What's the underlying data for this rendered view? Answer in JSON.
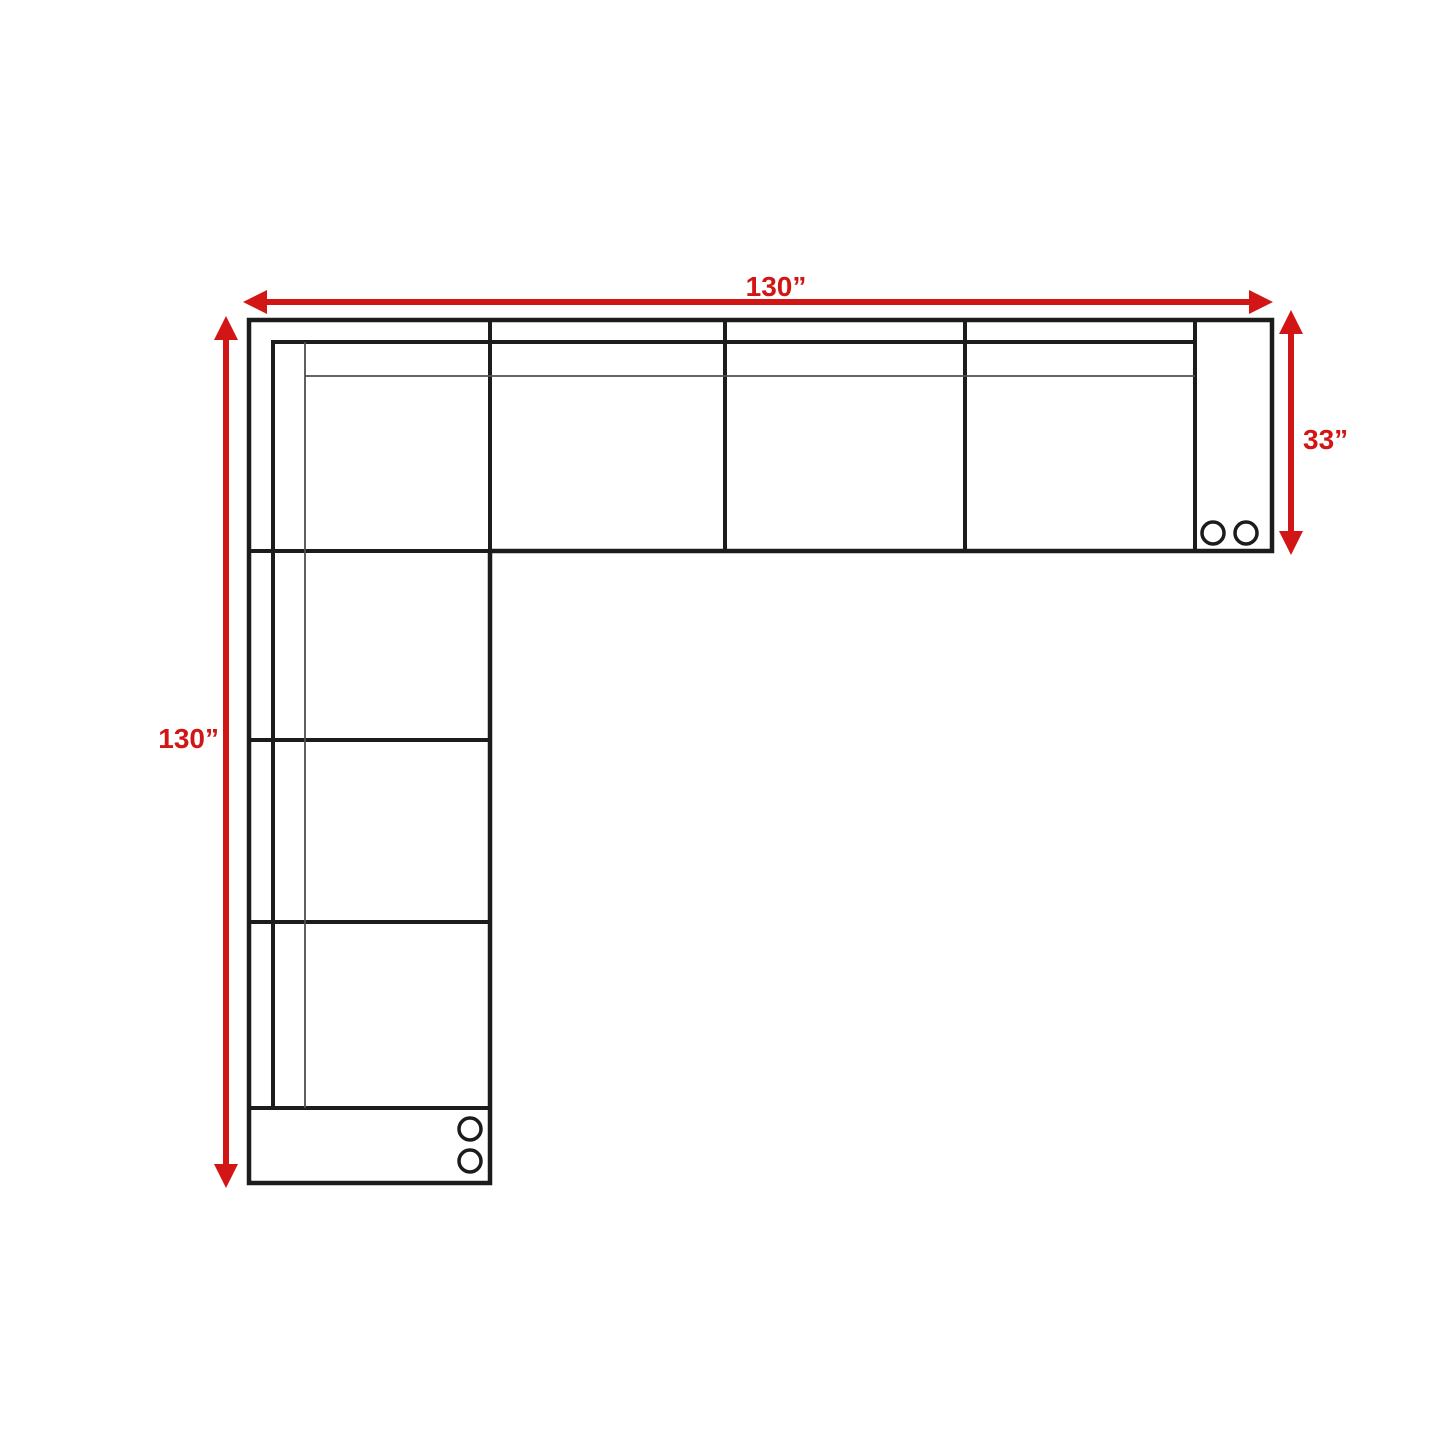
{
  "diagram": {
    "subject": "sectional-sofa-floorplan",
    "labels": {
      "width": "130”",
      "height": "130”",
      "depth": "33”"
    },
    "colors": {
      "accent": "#d21515",
      "line": "#1c1c1c",
      "thin_line": "#4f4f4f",
      "background": "#ffffff"
    }
  }
}
